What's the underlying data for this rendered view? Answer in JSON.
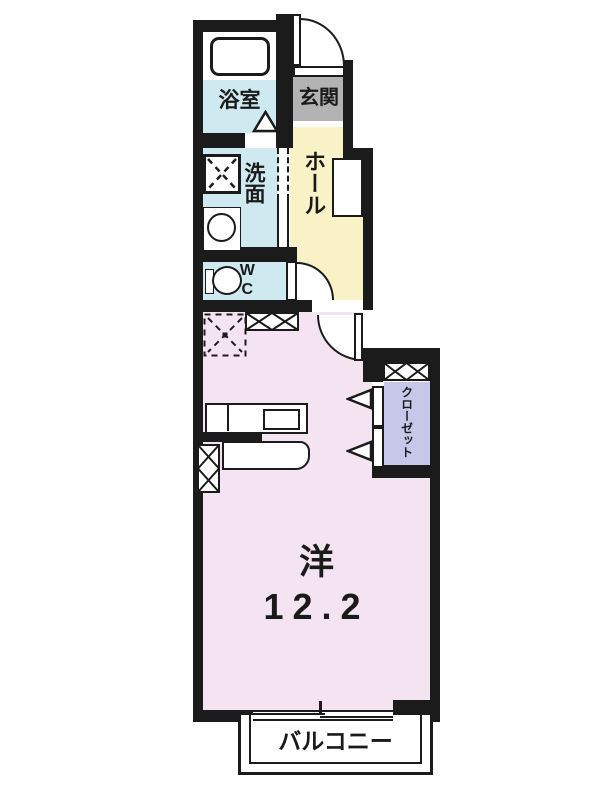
{
  "rooms": {
    "bathroom": {
      "label": "浴室"
    },
    "entrance": {
      "label": "玄関"
    },
    "washroom": {
      "label": "洗面"
    },
    "hall": {
      "label": "ホール"
    },
    "wc": {
      "label": "WC"
    },
    "closet": {
      "label": "クローゼット"
    },
    "main_room": {
      "type": "洋",
      "size": "12.2"
    },
    "balcony": {
      "label": "バルコニー"
    }
  },
  "colors": {
    "wall": "#1b1b1b",
    "wet_area": "#cfe9f1",
    "hall": "#f8f2c6",
    "main_room": "#f4e3f0",
    "closet": "#c6c7e9",
    "entrance": "#b3b3b3",
    "background": "#ffffff"
  }
}
